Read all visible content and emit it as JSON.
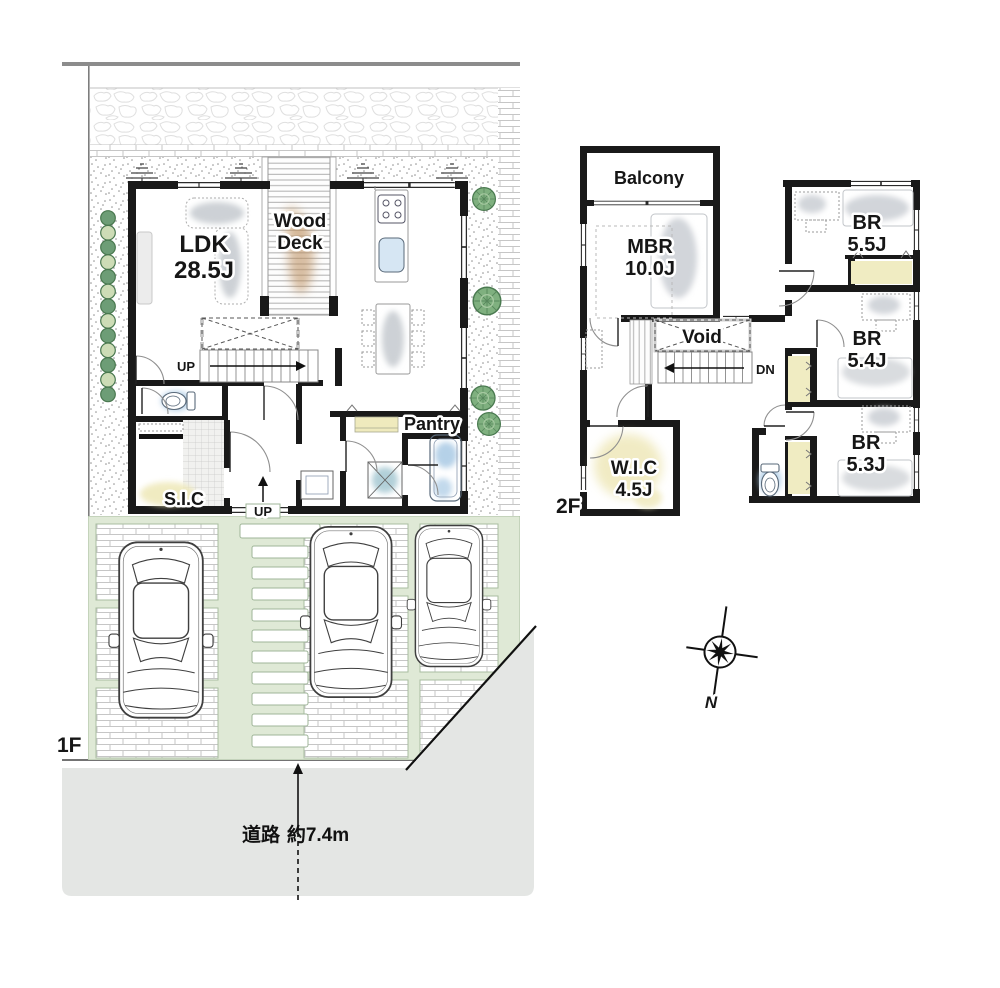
{
  "floor1": {
    "label": "1F",
    "ldk": {
      "name": "LDK",
      "size": "28.5J"
    },
    "wood_deck": {
      "line1": "Wood",
      "line2": "Deck"
    },
    "stairs_up": "UP",
    "entry_up": "UP",
    "pantry": "Pantry",
    "sic": "S.I.C"
  },
  "floor2": {
    "label": "2F",
    "balcony": "Balcony",
    "mbr": {
      "name": "MBR",
      "size": "10.0J"
    },
    "void": "Void",
    "stairs_down": "DN",
    "bedrooms": [
      {
        "name": "BR",
        "size": "5.5J"
      },
      {
        "name": "BR",
        "size": "5.4J"
      },
      {
        "name": "BR",
        "size": "5.3J"
      }
    ],
    "wic": {
      "name": "W.I.C",
      "size": "4.5J"
    }
  },
  "site": {
    "road_label": "道路",
    "road_width": "約7.4m"
  },
  "compass": {
    "north": "N"
  },
  "colors": {
    "wall": "#191919",
    "lawn": "#dfe9d6",
    "tree": "#7fb07f",
    "hedge_dark": "#6d9d76",
    "hedge_light": "#cddcb6",
    "road": "#e4e6e4",
    "water": "#a9c9e4",
    "closet": "#efe9bb",
    "deck_wood": "#b98a58"
  }
}
